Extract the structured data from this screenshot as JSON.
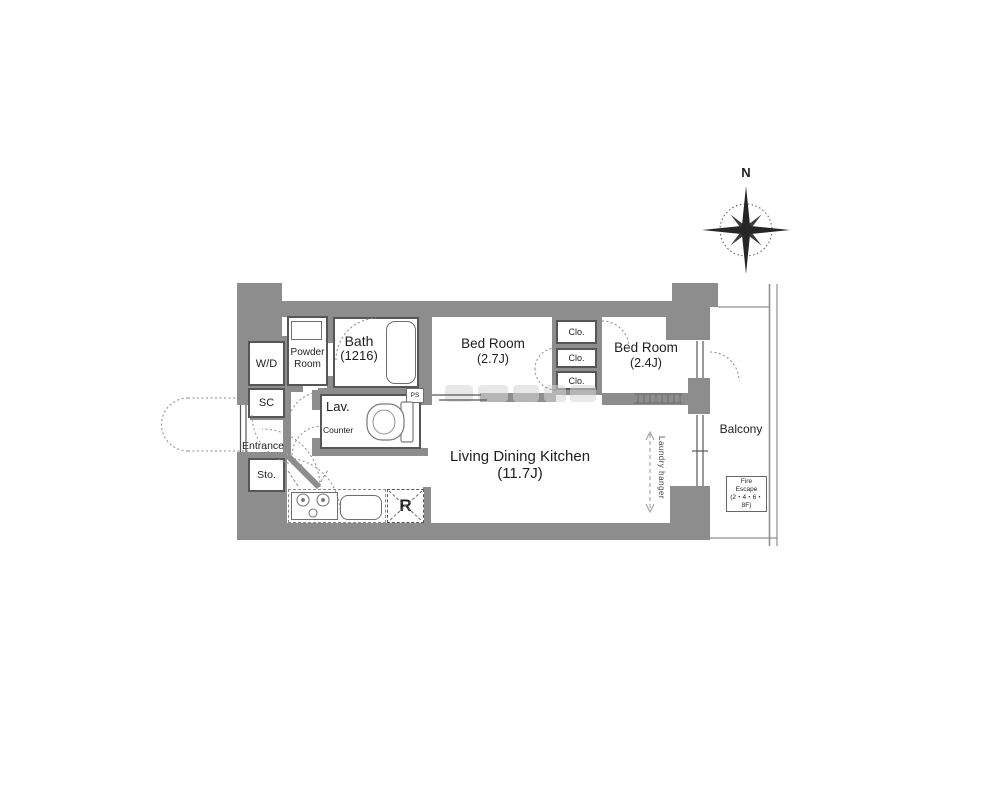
{
  "plan": {
    "compass_label": "N",
    "rooms": {
      "wd": "W/D",
      "powder1": "Powder",
      "powder2": "Room",
      "bath": "Bath",
      "bath_size": "(1216)",
      "bed1": "Bed Room",
      "bed1_size": "(2.7J)",
      "bed2": "Bed Room",
      "bed2_size": "(2.4J)",
      "ldk": "Living Dining Kitchen",
      "ldk_size": "(11.7J)",
      "sc": "SC",
      "entrance": "Entrance",
      "sto": "Sto.",
      "lav": "Lav.",
      "counter": "Counter",
      "ps": "PS",
      "fridge": "R",
      "balcony": "Balcony",
      "laundry": "Laundry hanger"
    },
    "closets": [
      "Clo.",
      "Clo.",
      "Clo."
    ],
    "fire_escape": {
      "line1": "Fire",
      "line2": "Escape",
      "line3": "(2・4・6・8F)"
    },
    "colors": {
      "wall": "#8d8d8d",
      "line": "#565656",
      "text": "#1e1e1e"
    }
  }
}
